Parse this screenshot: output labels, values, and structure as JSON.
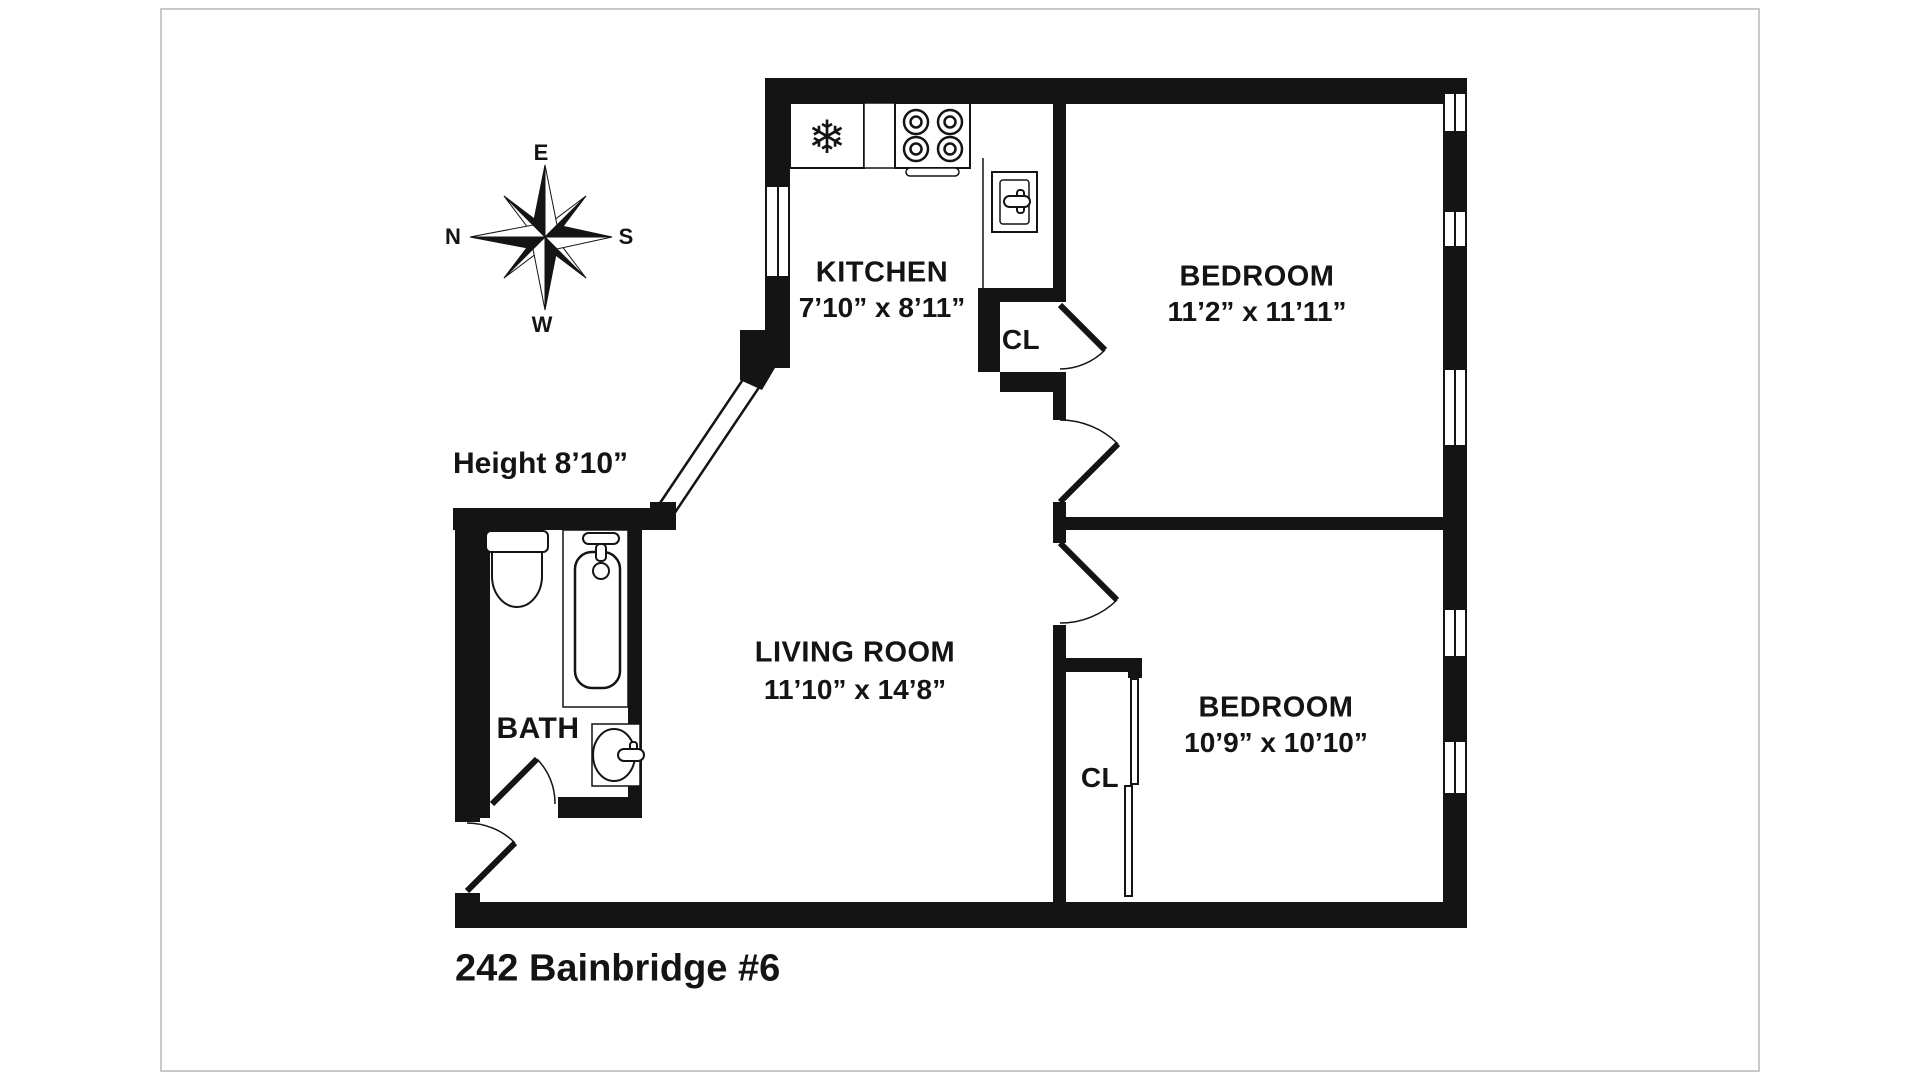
{
  "title": "242 Bainbridge #6",
  "height_note": "Height 8’10”",
  "compass": {
    "e": "E",
    "n": "N",
    "s": "S",
    "w": "W"
  },
  "rooms": {
    "kitchen": {
      "name": "KITCHEN",
      "dims": "7’10” x 8’11”"
    },
    "bedroom1": {
      "name": "BEDROOM",
      "dims": "11’2” x 11’11”"
    },
    "bedroom2": {
      "name": "BEDROOM",
      "dims": "10’9” x 10’10”"
    },
    "living_room": {
      "name": "LIVING ROOM",
      "dims": "11’10” x 14’8”"
    },
    "bath": {
      "name": "BATH"
    },
    "closet_kitchen": {
      "name": "CL"
    },
    "closet_bedroom2": {
      "name": "CL"
    }
  },
  "icons": {
    "snowflake": "❄"
  },
  "colors": {
    "wall": "#141414",
    "page_background": "#ffffff",
    "page_border": "#c9c9c9"
  }
}
